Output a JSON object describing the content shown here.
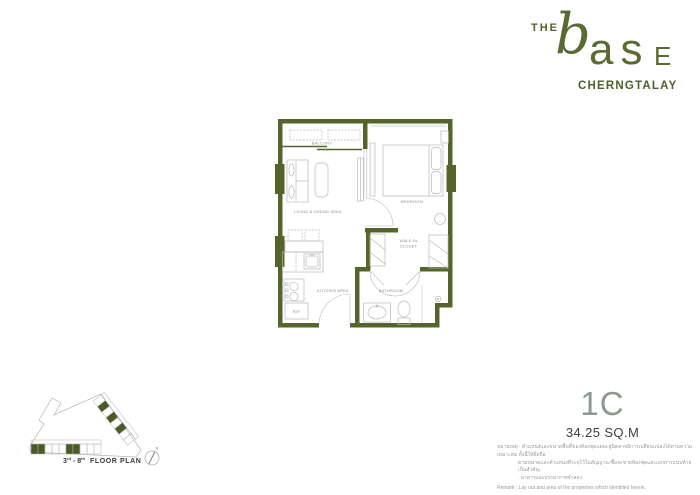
{
  "brand": {
    "the": "THE",
    "b": "b",
    "as": "as",
    "e": "E",
    "subtitle": "CHERNGTALAY"
  },
  "floorplan": {
    "rooms": {
      "balcony": "BALCONY",
      "living": "LIVING & DINING AREA",
      "kitchen": "KITCHEN AREA",
      "ref": "REF",
      "bedroom": "BEDROOM",
      "closet1": "WALK-IN",
      "closet2": "CLOSET",
      "bathroom": "BATHROOM"
    }
  },
  "keyplan": {
    "num1": "3",
    "sup1": "rd",
    "dash": "-",
    "num2": "8",
    "sup2": "th",
    "label": "FLOOR PLAN",
    "north": "N"
  },
  "unit": {
    "code": "1C",
    "area": "34.25 SQ.M"
  },
  "disclaimer": {
    "th1": "หมายเหตุ : ตำแหน่งและขนาดพื้นที่ของห้องชุดแต่ละยูนิตอาจมีการเปลี่ยนแปลงได้ตามความเหมาะสม ทั้งนี้ให้ยึดถือ",
    "th2": "ตามขนาดและตำแหน่งที่ระบุไว้ในสัญญาจะซื้อจะขายห้องชุดและเอกสารแนบท้ายเป็นสำคัญ",
    "th3": ": อาคารและบรรยากาศจำลอง",
    "remark": "Remark : Lay out and area of the properties which identified herein."
  },
  "colors": {
    "brand_green": "#5a6a33",
    "wall_green": "#55642b",
    "keyplan_highlight": "#4c5b26",
    "unit_code_gray": "#8f998f",
    "furniture_gray": "#b8b8b8",
    "label_gray": "#8f8f8f"
  }
}
